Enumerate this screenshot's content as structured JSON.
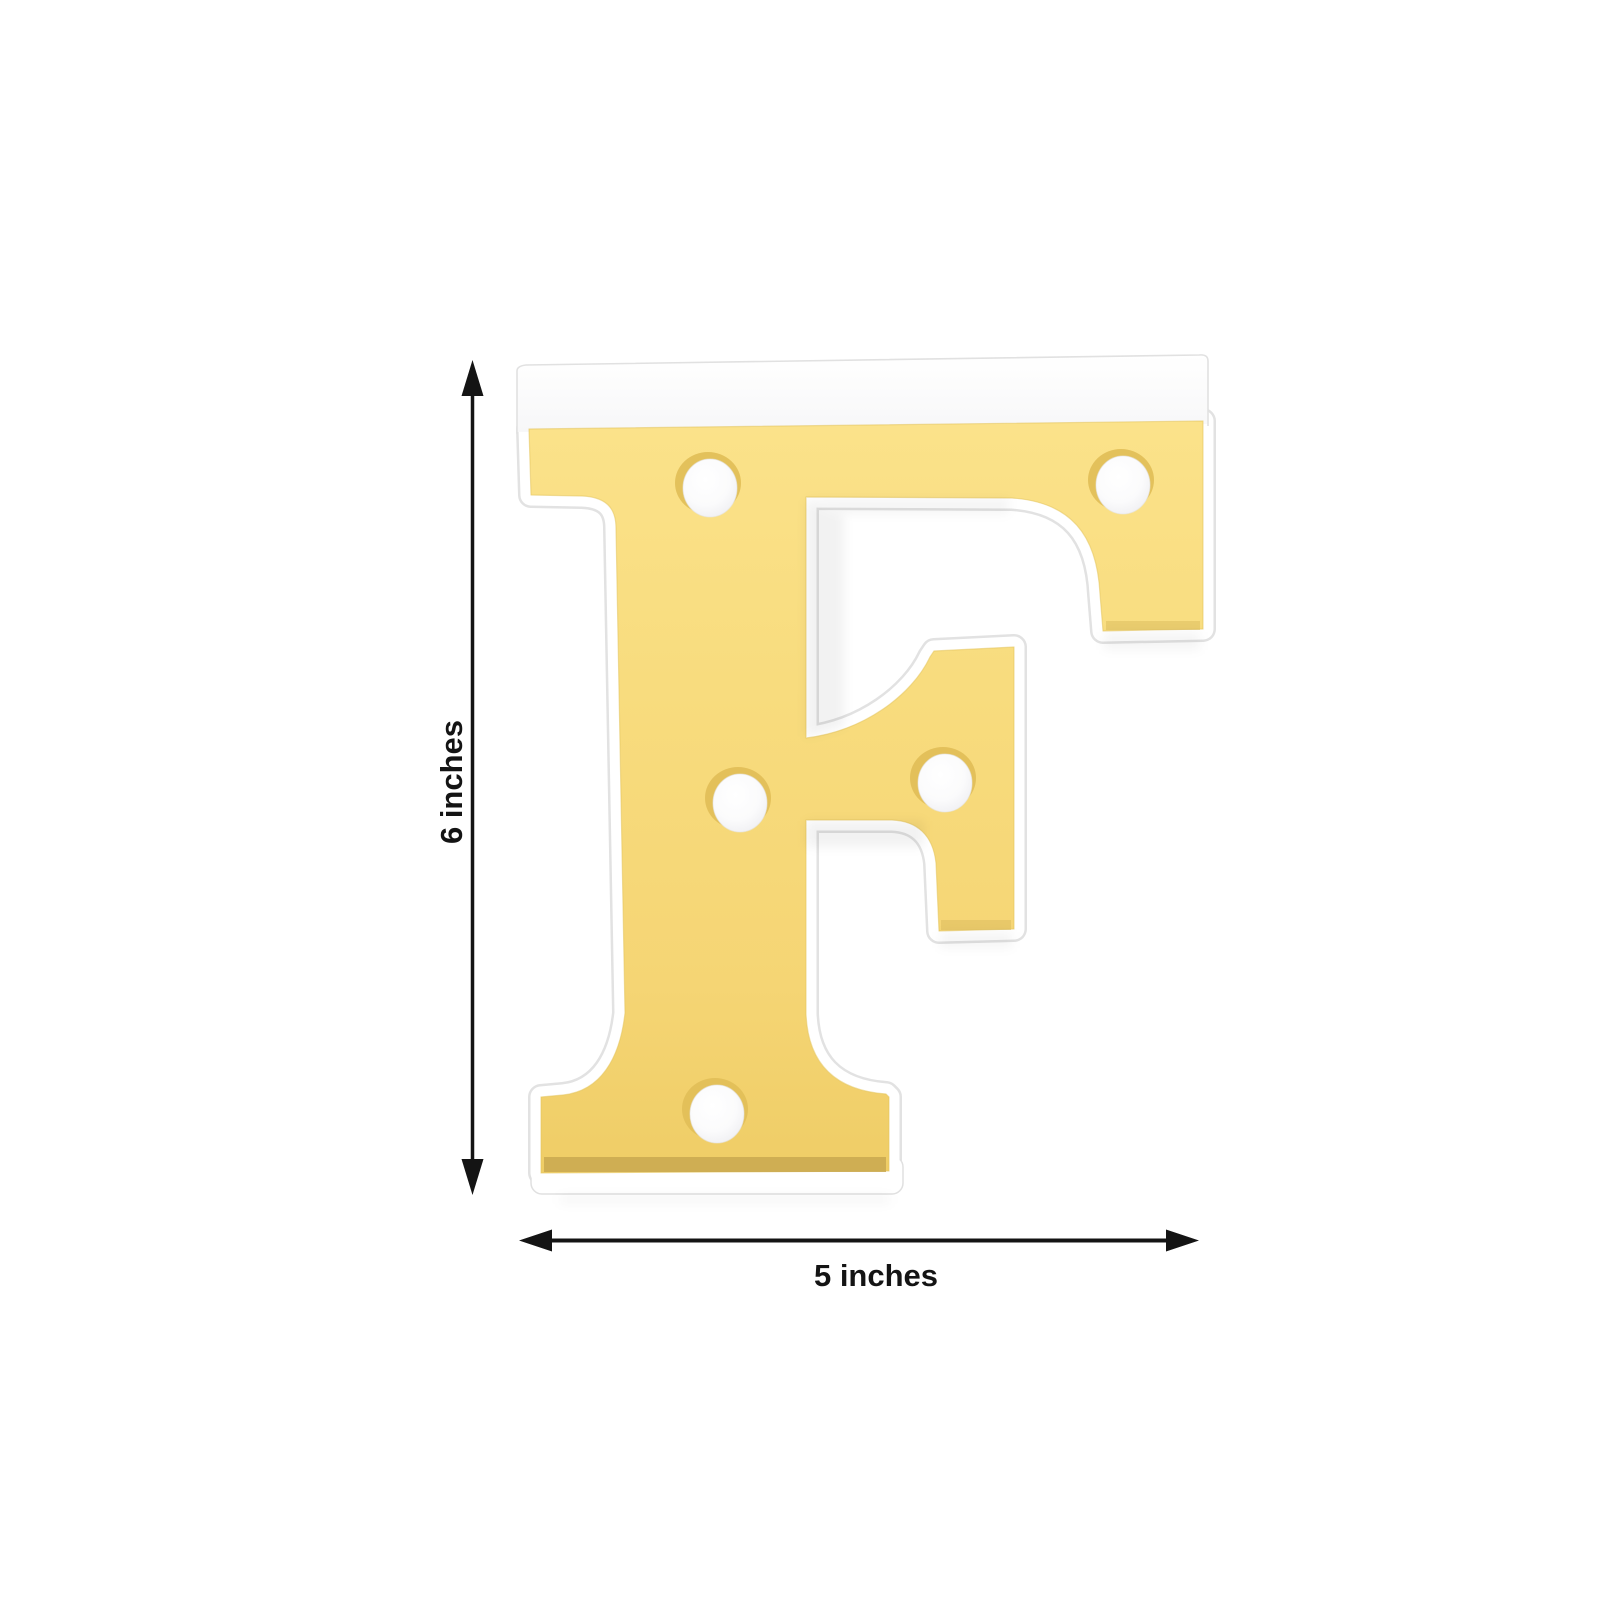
{
  "product": {
    "letter": "F",
    "description": "LED marquee letter light",
    "face_color": "#f7da7c",
    "body_color": "#ffffff",
    "led_bulb_color": "#fdfdfe",
    "led_count": 5
  },
  "dimensions": {
    "height": {
      "label": "6 inches",
      "value": 6,
      "unit": "inches"
    },
    "width": {
      "label": "5 inches",
      "value": 5,
      "unit": "inches"
    }
  },
  "annotations": {
    "arrow_color": "#141414",
    "vertical_arrow": "double-headed-vertical-arrow",
    "horizontal_arrow": "double-headed-horizontal-arrow"
  },
  "background_color": "#ffffff"
}
